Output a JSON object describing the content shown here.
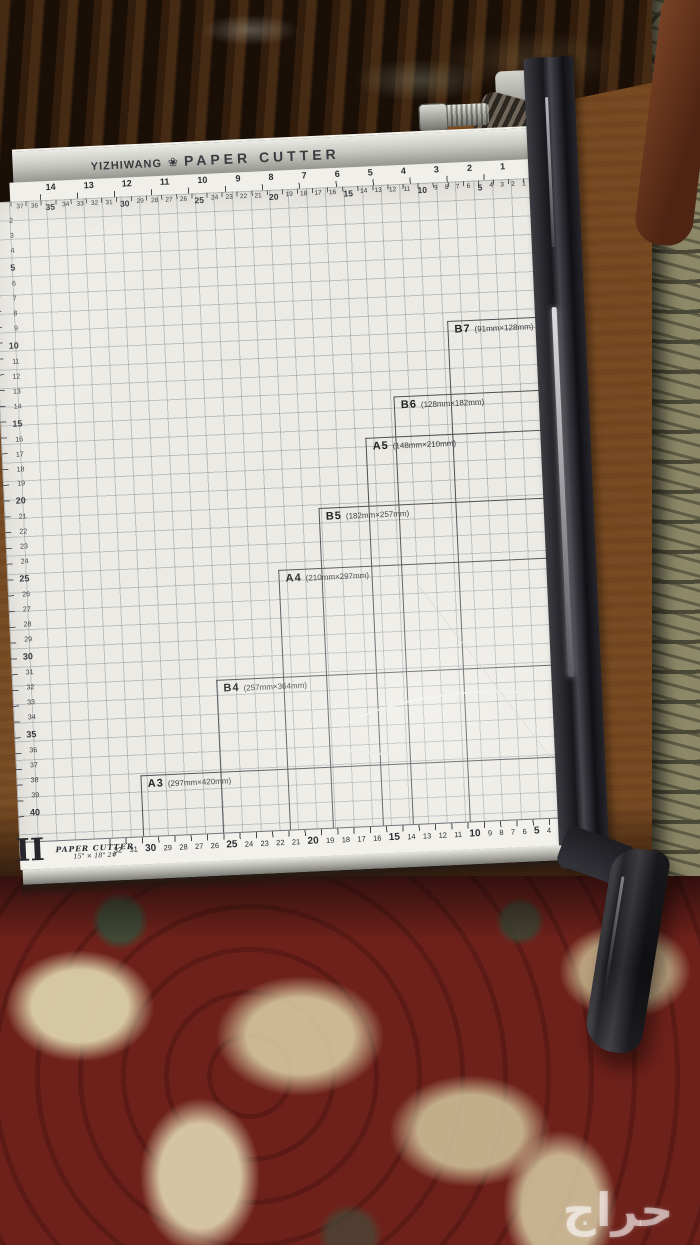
{
  "brand": {
    "name": "YIZHIWANG",
    "logo": "❀",
    "product": "PAPER CUTTER"
  },
  "sizes": [
    {
      "label": "B7",
      "dims": "(91mm×128mm)"
    },
    {
      "label": "B6",
      "dims": "(128mm×182mm)"
    },
    {
      "label": "A5",
      "dims": "(148mm×210mm)"
    },
    {
      "label": "B5",
      "dims": "(182mm×257mm)"
    },
    {
      "label": "A4",
      "dims": "(210mm×297mm)"
    },
    {
      "label": "B4",
      "dims": "(257mm×364mm)"
    },
    {
      "label": "A3",
      "dims": "(297mm×420mm)"
    }
  ],
  "rulers": {
    "top_inches": [
      "14",
      "13",
      "12",
      "11",
      "10",
      "9",
      "8",
      "7",
      "6",
      "5",
      "4",
      "3",
      "2",
      "1"
    ],
    "top_cm": [
      "37",
      "36",
      "35",
      "34",
      "33",
      "32",
      "31",
      "30",
      "29",
      "28",
      "27",
      "26",
      "25",
      "24",
      "23",
      "22",
      "21",
      "20",
      "19",
      "18",
      "17",
      "16",
      "15",
      "14",
      "13",
      "12",
      "11",
      "10",
      "9",
      "8",
      "7",
      "6",
      "5",
      "4",
      "3",
      "2",
      "1"
    ],
    "left_cm": [
      "2",
      "3",
      "4",
      "5",
      "6",
      "7",
      "8",
      "9",
      "10",
      "11",
      "12",
      "13",
      "14",
      "15",
      "16",
      "17",
      "18",
      "19",
      "20",
      "21",
      "22",
      "23",
      "24",
      "25",
      "26",
      "27",
      "28",
      "29",
      "30",
      "31",
      "32",
      "33",
      "34",
      "35",
      "36",
      "37",
      "38",
      "39",
      "40"
    ],
    "bottom_cm": [
      "32",
      "31",
      "30",
      "29",
      "28",
      "27",
      "26",
      "25",
      "24",
      "23",
      "22",
      "21",
      "20",
      "19",
      "18",
      "17",
      "16",
      "15",
      "14",
      "13",
      "12",
      "11",
      "10",
      "9",
      "8",
      "7",
      "6",
      "5",
      "4",
      "3",
      "2",
      "CM"
    ]
  },
  "base": {
    "mark": "II",
    "line1": "PAPER CUTTER",
    "line2": "15\" × 18\"  2#"
  },
  "watermark": "حراج",
  "colors": {
    "board": "#eceae4",
    "carpet_red": "#6e211b",
    "carpet_cream": "#d8cdaa",
    "table_brown": "#8d5a2b",
    "wood_dark": "#2c1a0c",
    "metal": "#c9c9c2",
    "blade_dark": "#17171c"
  }
}
